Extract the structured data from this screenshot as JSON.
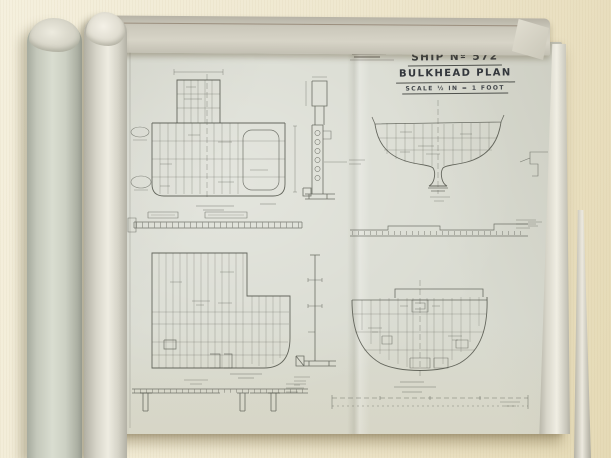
{
  "title_block": {
    "ship_no": "SHIP Nº 572",
    "plan_title": "BULKHEAD PLAN",
    "scale": "SCALE ½ IN = 1 FOOT"
  },
  "colors": {
    "table": "#efe8d0",
    "sheet": "#d9dbd1",
    "ink": "#4f5148",
    "roll_gray": "#ccd0c3",
    "roll_white": "#eeece1"
  }
}
